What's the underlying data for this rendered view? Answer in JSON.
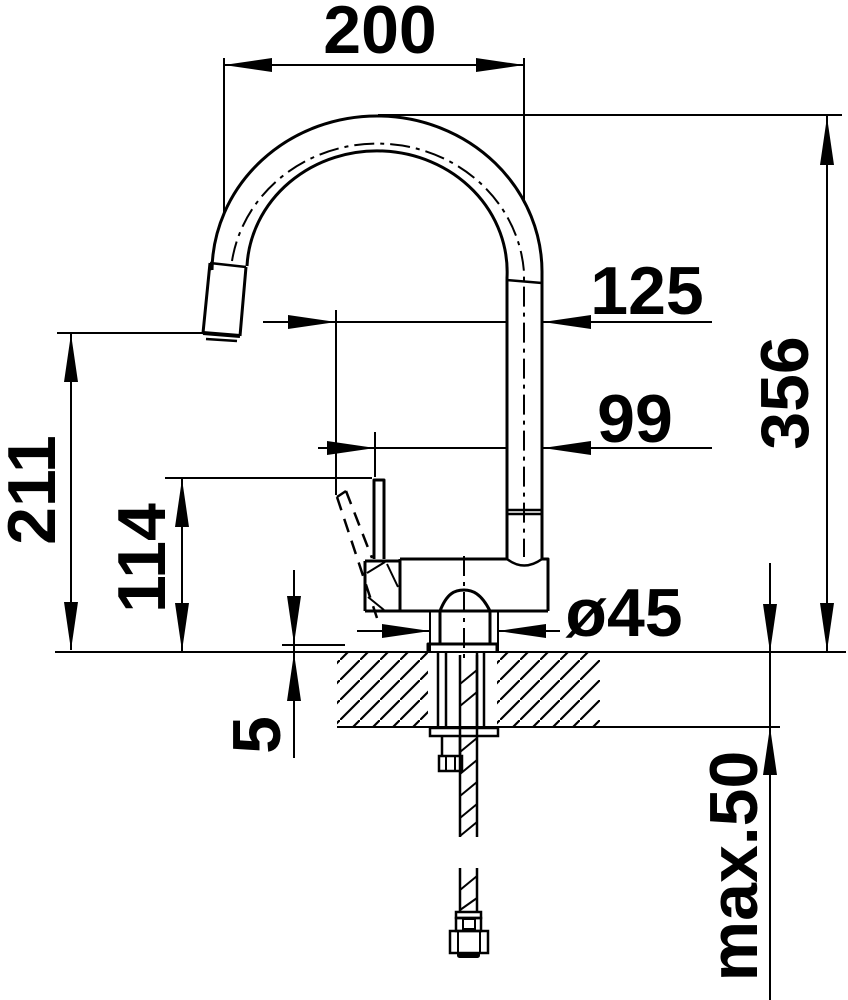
{
  "drawing": {
    "subject": "kitchen-faucet-dimension-drawing-side-view",
    "background_color": "#ffffff",
    "line_color": "#000000",
    "labels": {
      "spout_reach": "200",
      "offset_125": "125",
      "offset_99": "99",
      "outlet_height": "211",
      "lever_height": "114",
      "total_height": "356",
      "base_diameter": "ø45",
      "base_plate_gap": "5",
      "max_counter_thickness": "max.50"
    }
  }
}
